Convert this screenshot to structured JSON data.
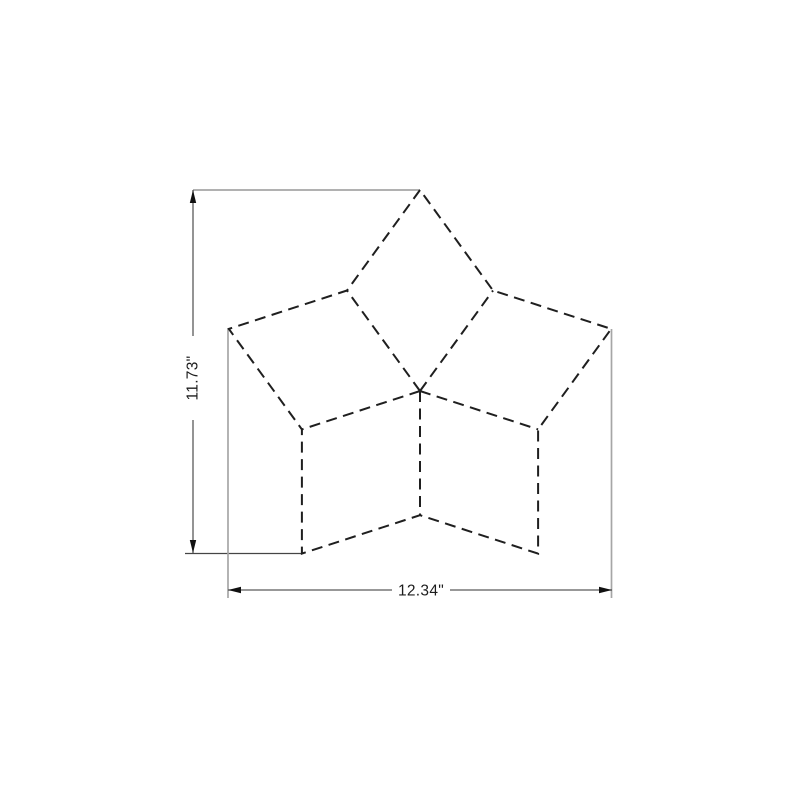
{
  "drawing": {
    "description": "Dimensioned outline drawing of a five-point star pieced from five rhombus patches, all edges drawn as black dashed lines, with CAD-style dimension callouts",
    "colors": {
      "background": "#ffffff",
      "outline": "#1f1f1f",
      "dimension-line": "#5a5a5a",
      "extension-line": "#a6a6a6",
      "extension-dark": "#454545",
      "arrow": "#111111",
      "text": "#1c1c1c"
    },
    "star": {
      "points": 5,
      "center_x": 420,
      "center_y": 391,
      "outer_radius": 201,
      "inner_radius": 124.2,
      "start_angle_deg": 90,
      "dash_pattern": "11 6.5"
    },
    "dimensions": {
      "height": {
        "label": "11.73\"",
        "value_inches": 11.73,
        "axis": "vertical"
      },
      "width": {
        "label": "12.34\"",
        "value_inches": 12.34,
        "axis": "horizontal"
      }
    }
  }
}
